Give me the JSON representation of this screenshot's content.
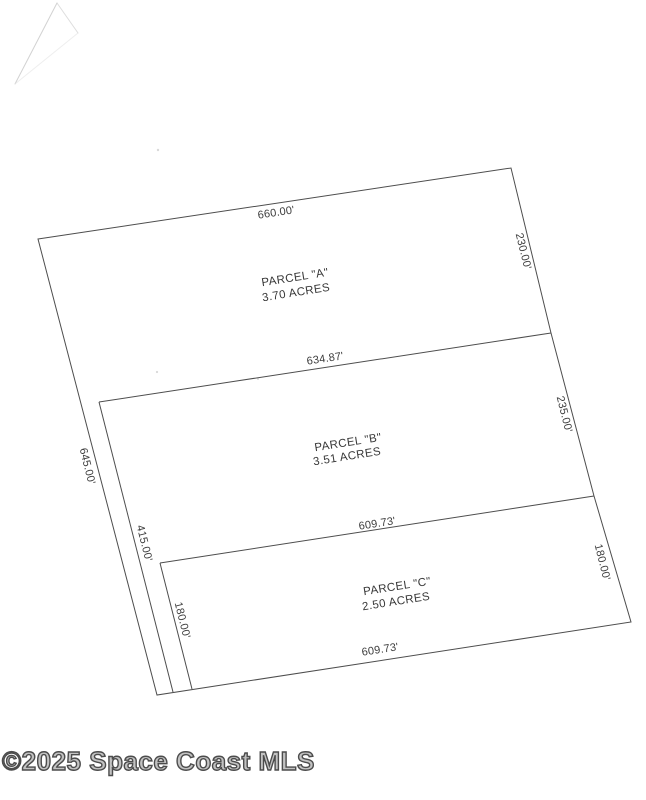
{
  "page": {
    "background": "#ffffff"
  },
  "watermark": {
    "text": "©2025 Space Coast MLS",
    "color": "#4c4c4c"
  },
  "survey": {
    "line_color": "#4d4d4d",
    "parcels": [
      {
        "id": "A",
        "name": "PARCEL \"A\"",
        "acreage": "3.70 ACRES"
      },
      {
        "id": "B",
        "name": "PARCEL \"B\"",
        "acreage": "3.51 ACRES"
      },
      {
        "id": "C",
        "name": "PARCEL \"C\"",
        "acreage": "2.50 ACRES"
      }
    ],
    "dimensions": [
      {
        "edge": "parcel-a-north-boundary",
        "label": "660.00'"
      },
      {
        "edge": "parcel-a-east-boundary",
        "label": "230.00'"
      },
      {
        "edge": "parcel-a-b-boundary",
        "label": "634.87'"
      },
      {
        "edge": "parcel-b-east-boundary",
        "label": "235.00'"
      },
      {
        "edge": "parcel-b-c-boundary",
        "label": "609.73'"
      },
      {
        "edge": "parcel-c-east-boundary",
        "label": "180.00'"
      },
      {
        "edge": "parcel-c-south-boundary",
        "label": "609.73'"
      },
      {
        "edge": "west-outer-boundary",
        "label": "645.00'"
      },
      {
        "edge": "flag-strip-west-parcel-b",
        "label": "415.00'"
      },
      {
        "edge": "parcel-c-west-boundary",
        "label": "180.00'"
      }
    ]
  }
}
